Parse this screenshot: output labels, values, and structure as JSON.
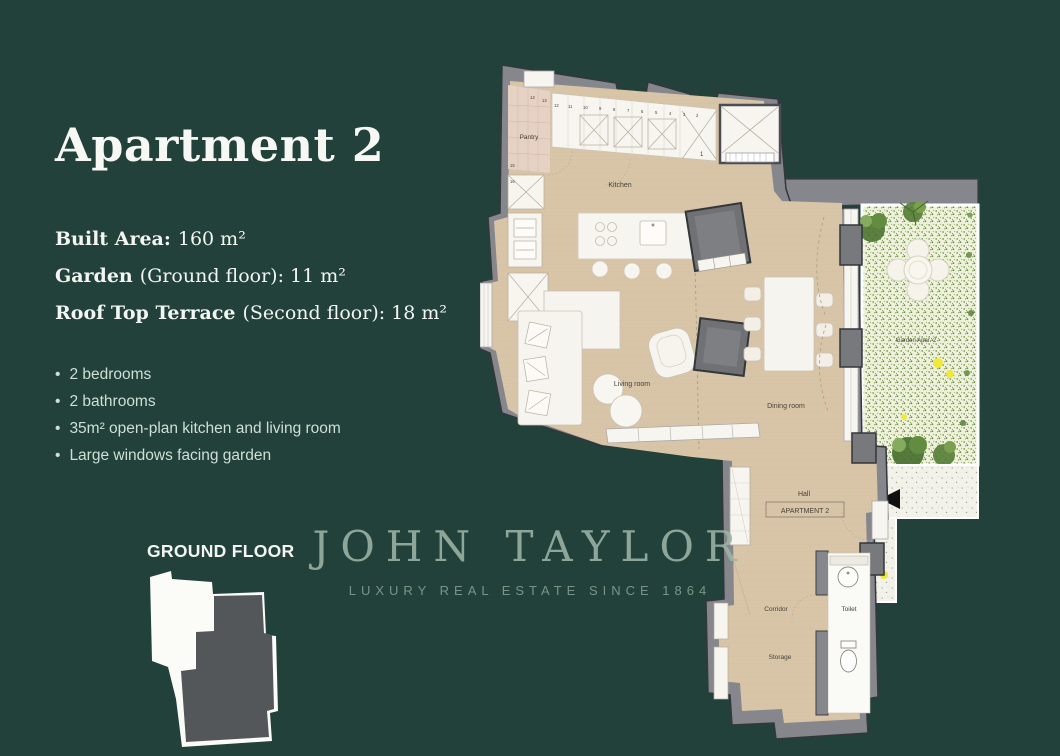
{
  "colors": {
    "background": "#22413a",
    "floor_beige": "#d8c5a8",
    "wall_gray": "#85878d",
    "garden_green": "#7d9a51",
    "accent_yellow": "#efe93a",
    "text_white": "#f7f8f4",
    "watermark_green": "#9db4a7",
    "silhouette_dark": "#54575a"
  },
  "left_panel": {
    "title": "Apartment 2",
    "details": [
      {
        "label": "Built Area:",
        "value": "160 m²"
      },
      {
        "label": "Garden",
        "value": "(Ground floor): 11 m²"
      },
      {
        "label": "Roof Top Terrace",
        "value": "(Second floor): 18 m²"
      }
    ],
    "features": [
      "2 bedrooms",
      "2 bathrooms",
      "35m² open-plan kitchen and living room",
      "Large windows facing garden"
    ],
    "floor_label": "GROUND FLOOR"
  },
  "watermark": {
    "brand": "JOHN TAYLOR",
    "tagline": "LUXURY REAL ESTATE SINCE 1864"
  },
  "floorplan": {
    "labels": {
      "pantry": "Pantry",
      "kitchen": "Kitchen",
      "living_room": "Living room",
      "dining_room": "Dining room",
      "hall": "Hall",
      "apartment": "APARTMENT 2",
      "corridor": "Corridor",
      "toilet": "Toilet",
      "storage": "Storage",
      "garden": "Garden Apar. 2"
    },
    "cabinet_numbers": [
      "1",
      "2",
      "3",
      "4",
      "5",
      "6",
      "7",
      "8",
      "9",
      "10",
      "11",
      "12",
      "13",
      "14",
      "15",
      "16"
    ]
  }
}
